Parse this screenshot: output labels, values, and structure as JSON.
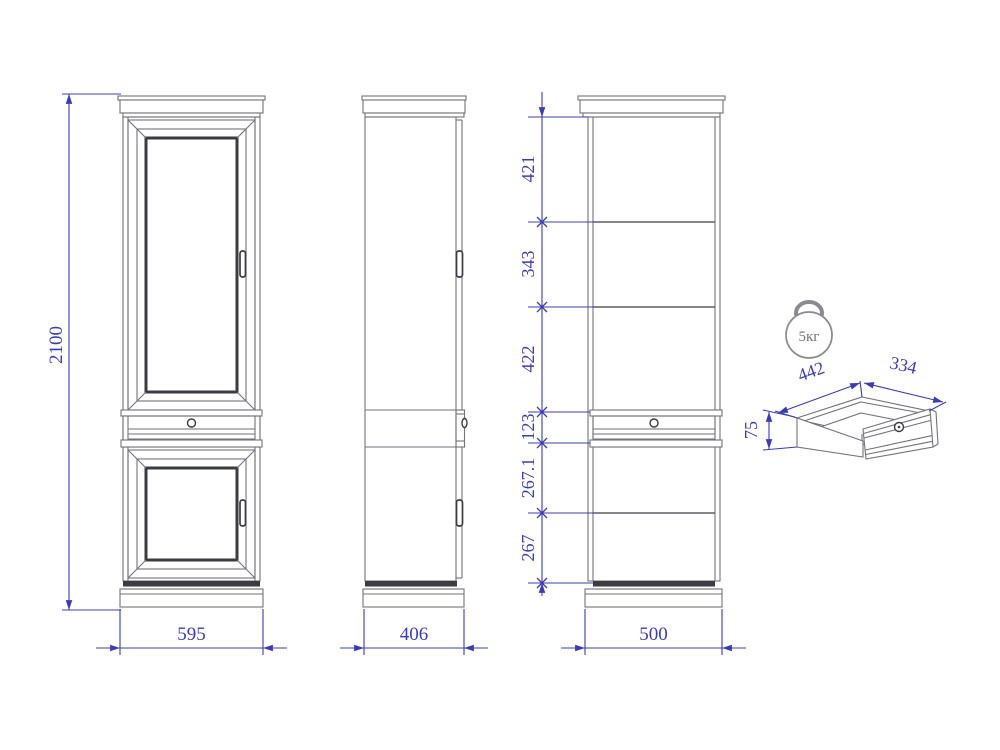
{
  "colors": {
    "dim": "#3d3db1",
    "line": "#72727a",
    "line-dark": "#3b3b42",
    "icon": "#8a8a90"
  },
  "dims": {
    "height": "2100",
    "front_width": "595",
    "side_depth": "406",
    "section_width": "500",
    "segments": [
      "421",
      "343",
      "422",
      "123",
      "267.1",
      "267"
    ]
  },
  "drawer": {
    "depth": "442",
    "width": "334",
    "height": "75",
    "capacity": "5кг"
  },
  "icons": {
    "weight": "kettlebell-weight-icon"
  }
}
